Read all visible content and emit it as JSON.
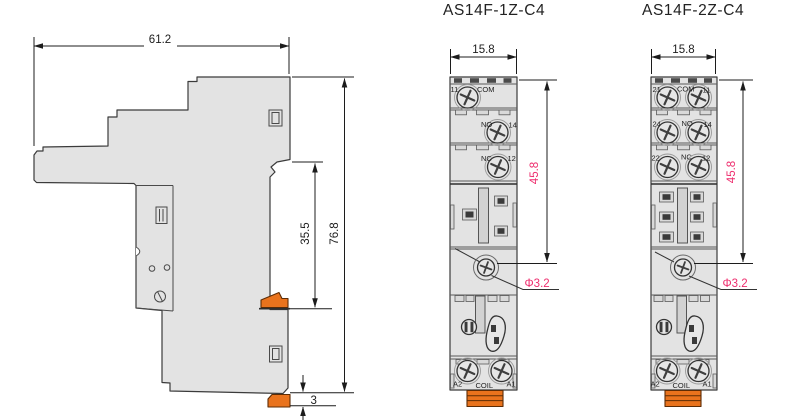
{
  "views": {
    "side": {
      "dim_width": "61.2",
      "dim_rail_height": "35.5",
      "dim_total_height": "76.8",
      "dim_clip_depth": "3"
    },
    "front_1z": {
      "title": "AS14F-1Z-C4",
      "dim_width": "15.8",
      "dim_height": "45.8",
      "dim_hole": "Φ3.2",
      "terminals": {
        "n11": "11",
        "com": "COM",
        "no": "NO",
        "n14": "14",
        "nc": "NC",
        "n12": "12",
        "a2": "A2",
        "coil": "COIL",
        "a1": "A1"
      }
    },
    "front_2z": {
      "title": "AS14F-2Z-C4",
      "dim_width": "15.8",
      "dim_height": "45.8",
      "dim_hole": "Φ3.2",
      "terminals": {
        "n21": "21",
        "com": "COM",
        "n11": "11",
        "n24": "24",
        "no": "NO",
        "n14": "14",
        "n22": "22",
        "nc": "NC",
        "n12": "12",
        "a2": "A2",
        "coil": "COIL",
        "a1": "A1"
      }
    }
  },
  "colors": {
    "body_fill": "#e3e3e3",
    "outline": "#3b3b3b",
    "clip_orange": "#e9731d",
    "dim_pink": "#ee2e6e",
    "dim_black": "#1c1c1c"
  }
}
